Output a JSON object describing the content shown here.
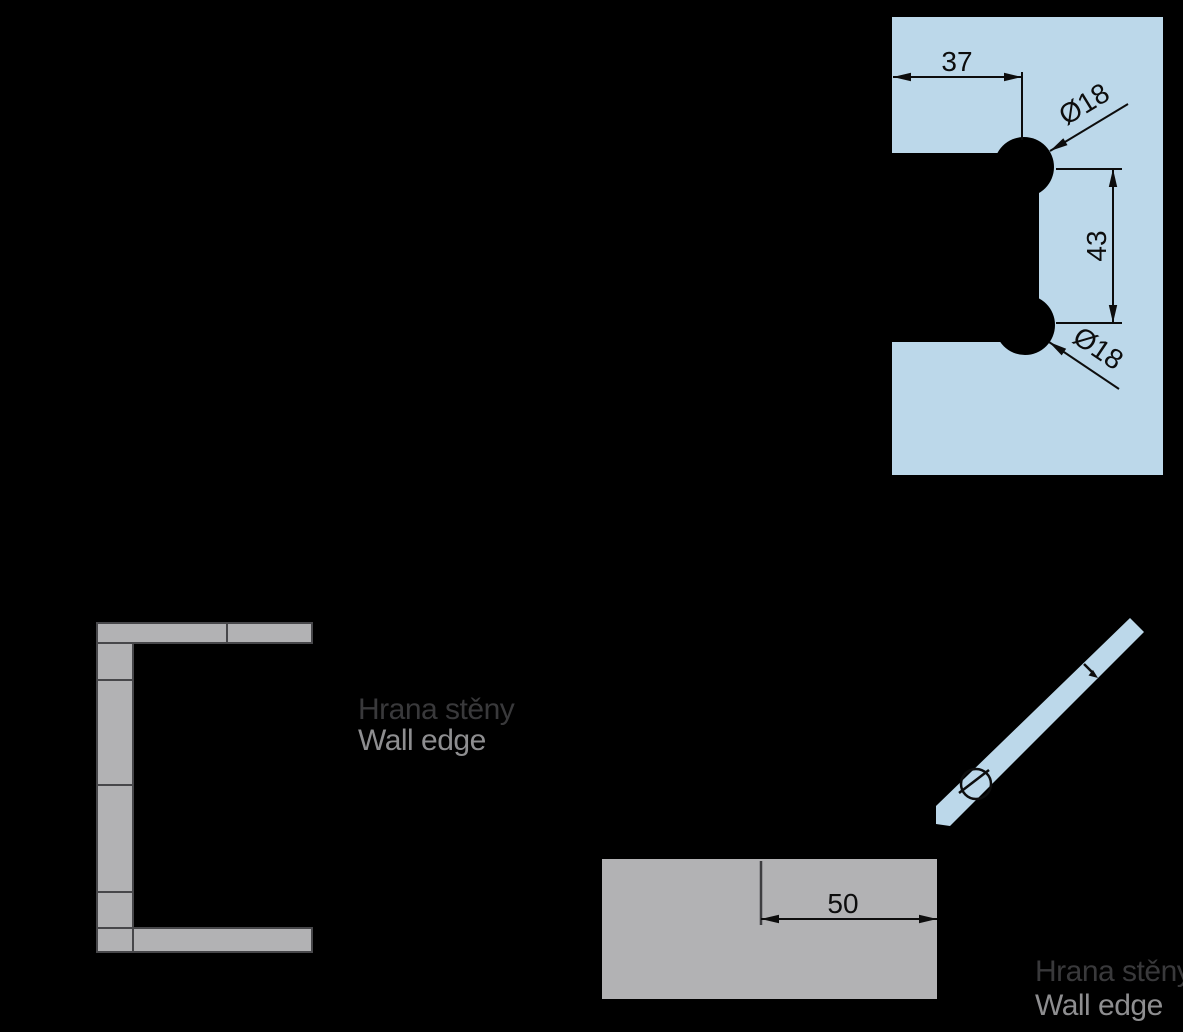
{
  "colors": {
    "background": "#000000",
    "glass": "#bcd8ea",
    "wall": "#b2b2b4",
    "outline": "#47474a",
    "dimension": "#0d0d0d",
    "label_primary": "#39393b",
    "label_secondary": "#8e8e90"
  },
  "glass_panel_view": {
    "dim_edge_to_hole": "37",
    "dim_hole_diameter_top": "Ø18",
    "dim_hole_spacing": "43",
    "dim_hole_diameter_bottom": "Ø18"
  },
  "wall_profile_view": {
    "label_cz": "Hrana stěny",
    "label_en": "Wall edge"
  },
  "wall_plan_view": {
    "dim_hinge_offset": "50",
    "label_cz": "Hrana stěny",
    "label_en": "Wall edge"
  }
}
